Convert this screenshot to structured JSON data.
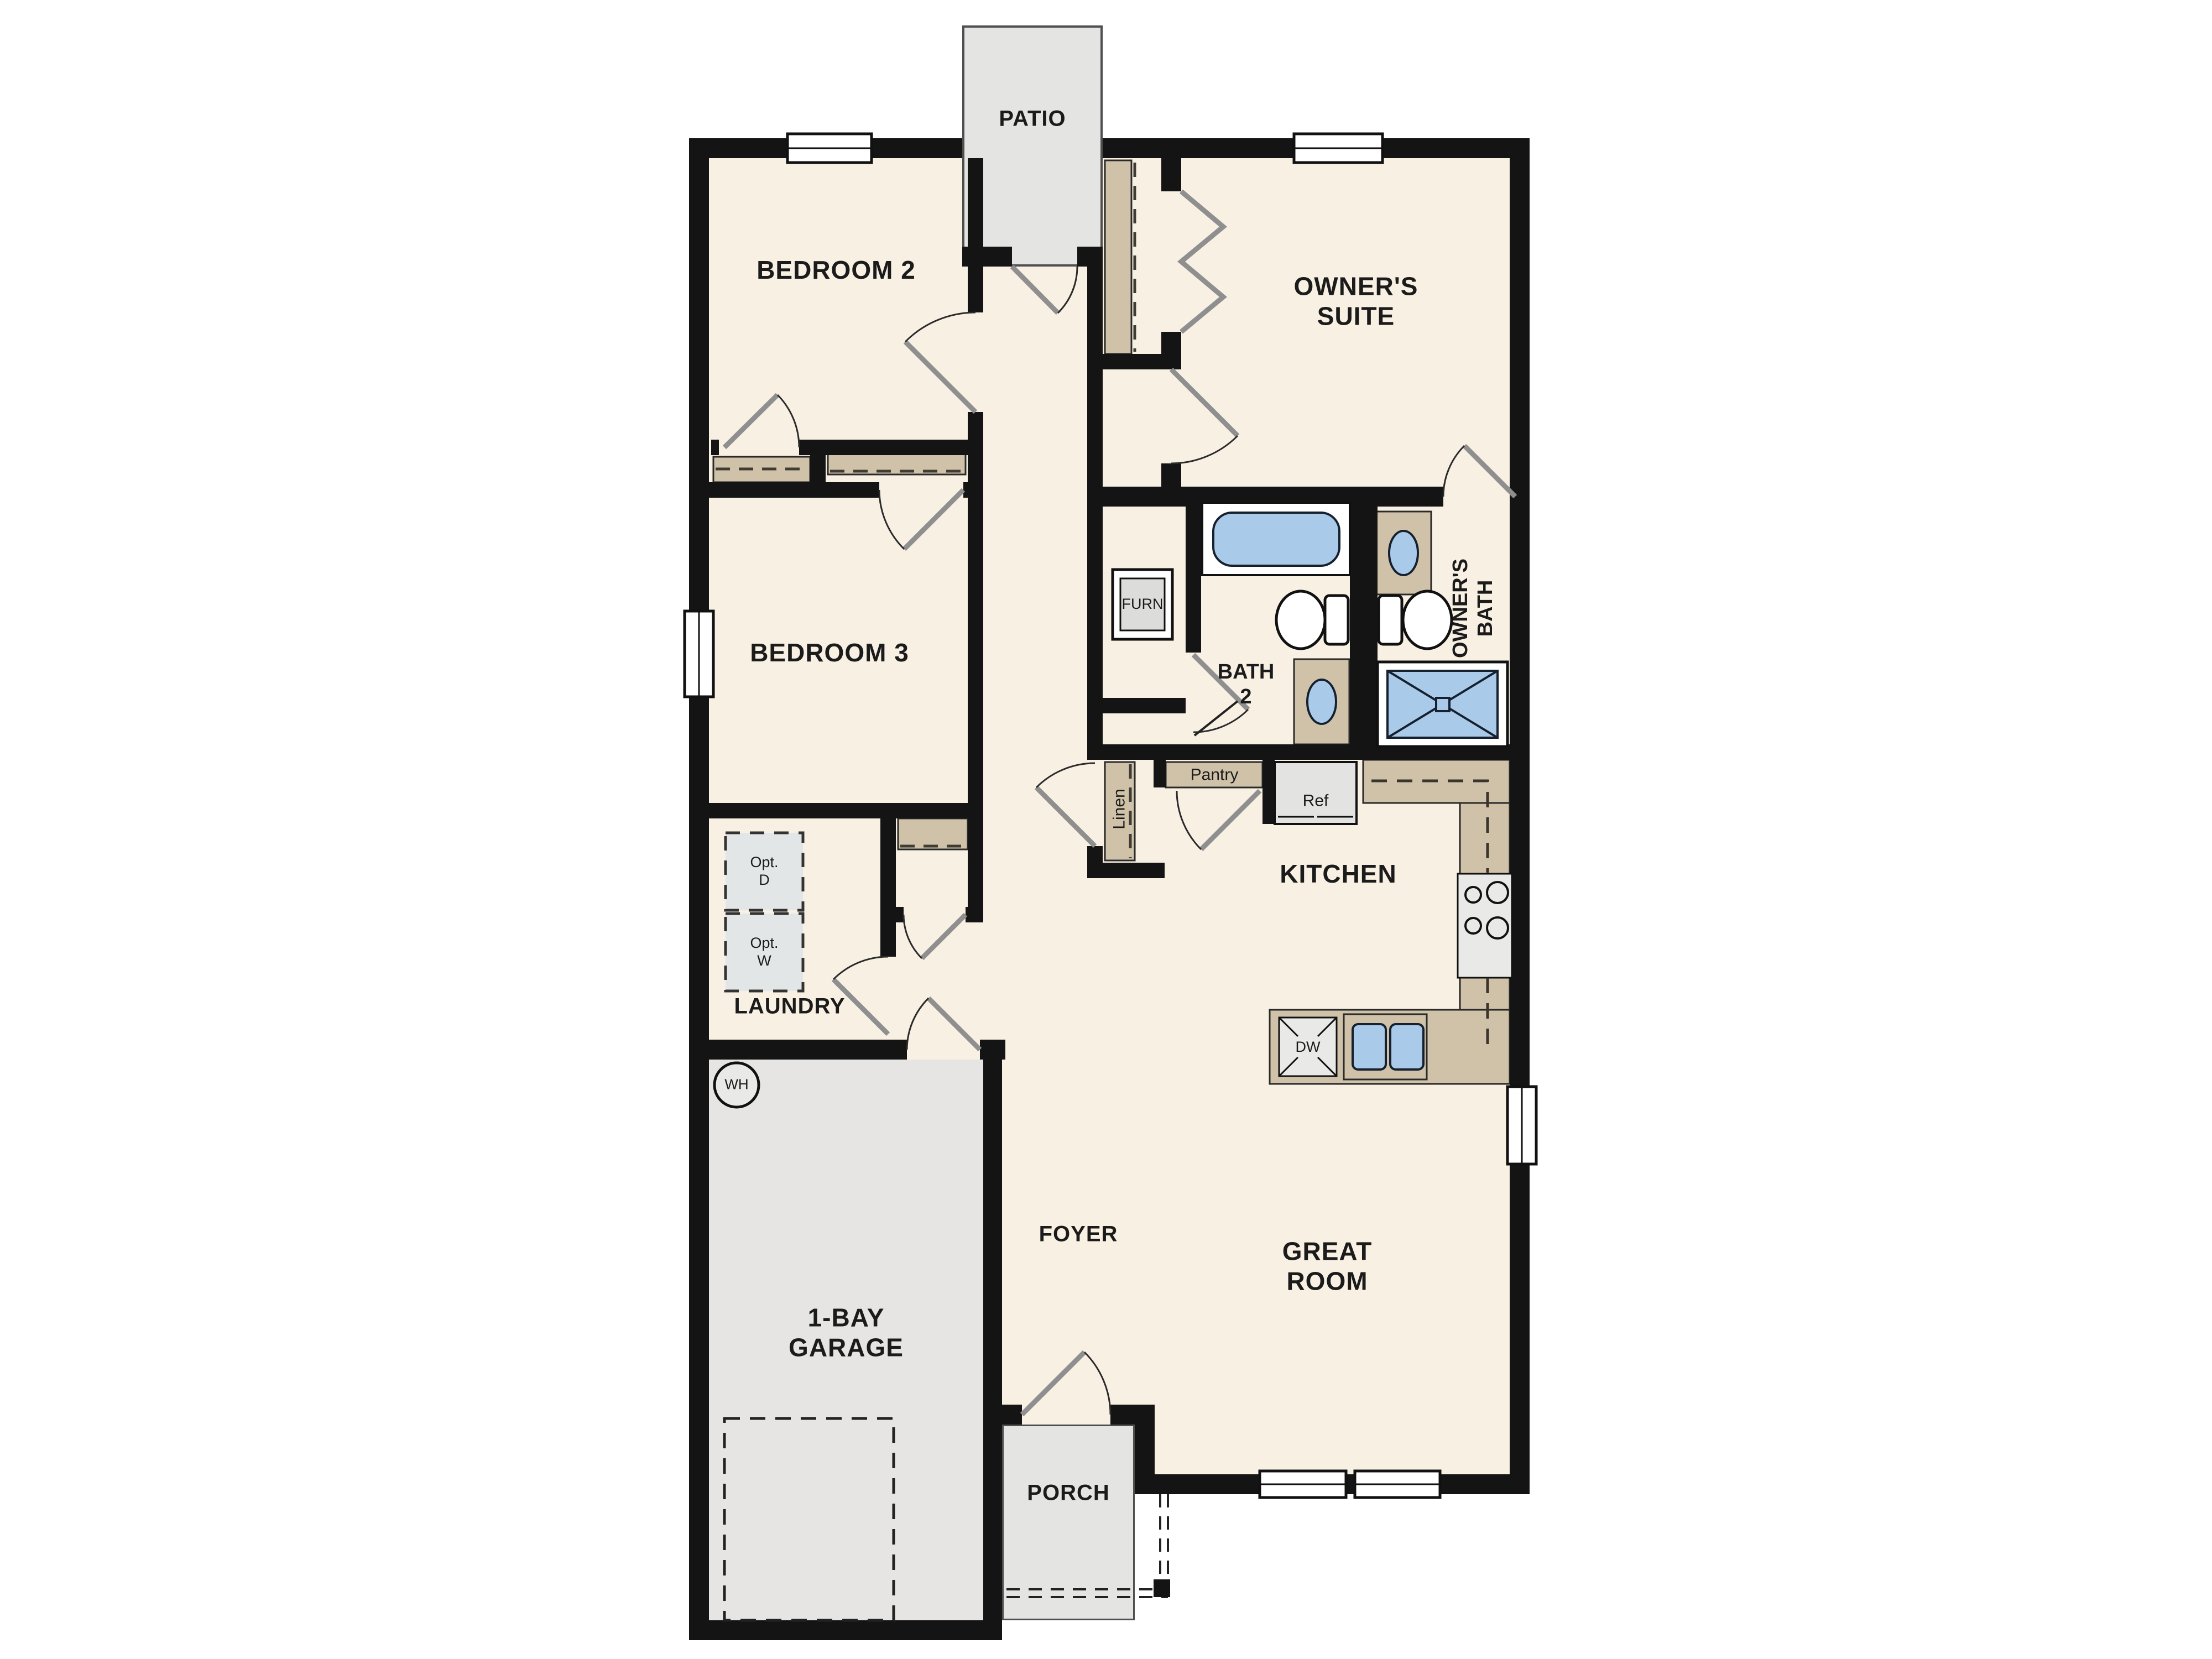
{
  "colors": {
    "wall": "#141414",
    "floor": "#f8f0e3",
    "outdoor": "#e6e5e3",
    "counter_tan": "#cfc2a8",
    "fixture_blue": "#a9cbe9",
    "appliance_gray": "#e8e8e6"
  },
  "rooms": {
    "patio": "PATIO",
    "bedroom2": "BEDROOM 2",
    "owners_suite": [
      "OWNER'S",
      "SUITE"
    ],
    "bedroom3": "BEDROOM 3",
    "owners_bath": [
      "OWNER'S",
      "BATH"
    ],
    "bath2": [
      "BATH",
      "2"
    ],
    "kitchen": "KITCHEN",
    "laundry": "LAUNDRY",
    "foyer": "FOYER",
    "great_room": [
      "GREAT",
      "ROOM"
    ],
    "garage": [
      "1-BAY",
      "GARAGE"
    ],
    "porch": "PORCH"
  },
  "fixtures": {
    "furnace": "FURN",
    "water_heater": "WH",
    "linen": "Linen",
    "pantry": "Pantry",
    "refrigerator": "Ref",
    "dishwasher": "DW",
    "opt_dryer": [
      "Opt.",
      "D"
    ],
    "opt_washer": [
      "Opt.",
      "W"
    ]
  }
}
